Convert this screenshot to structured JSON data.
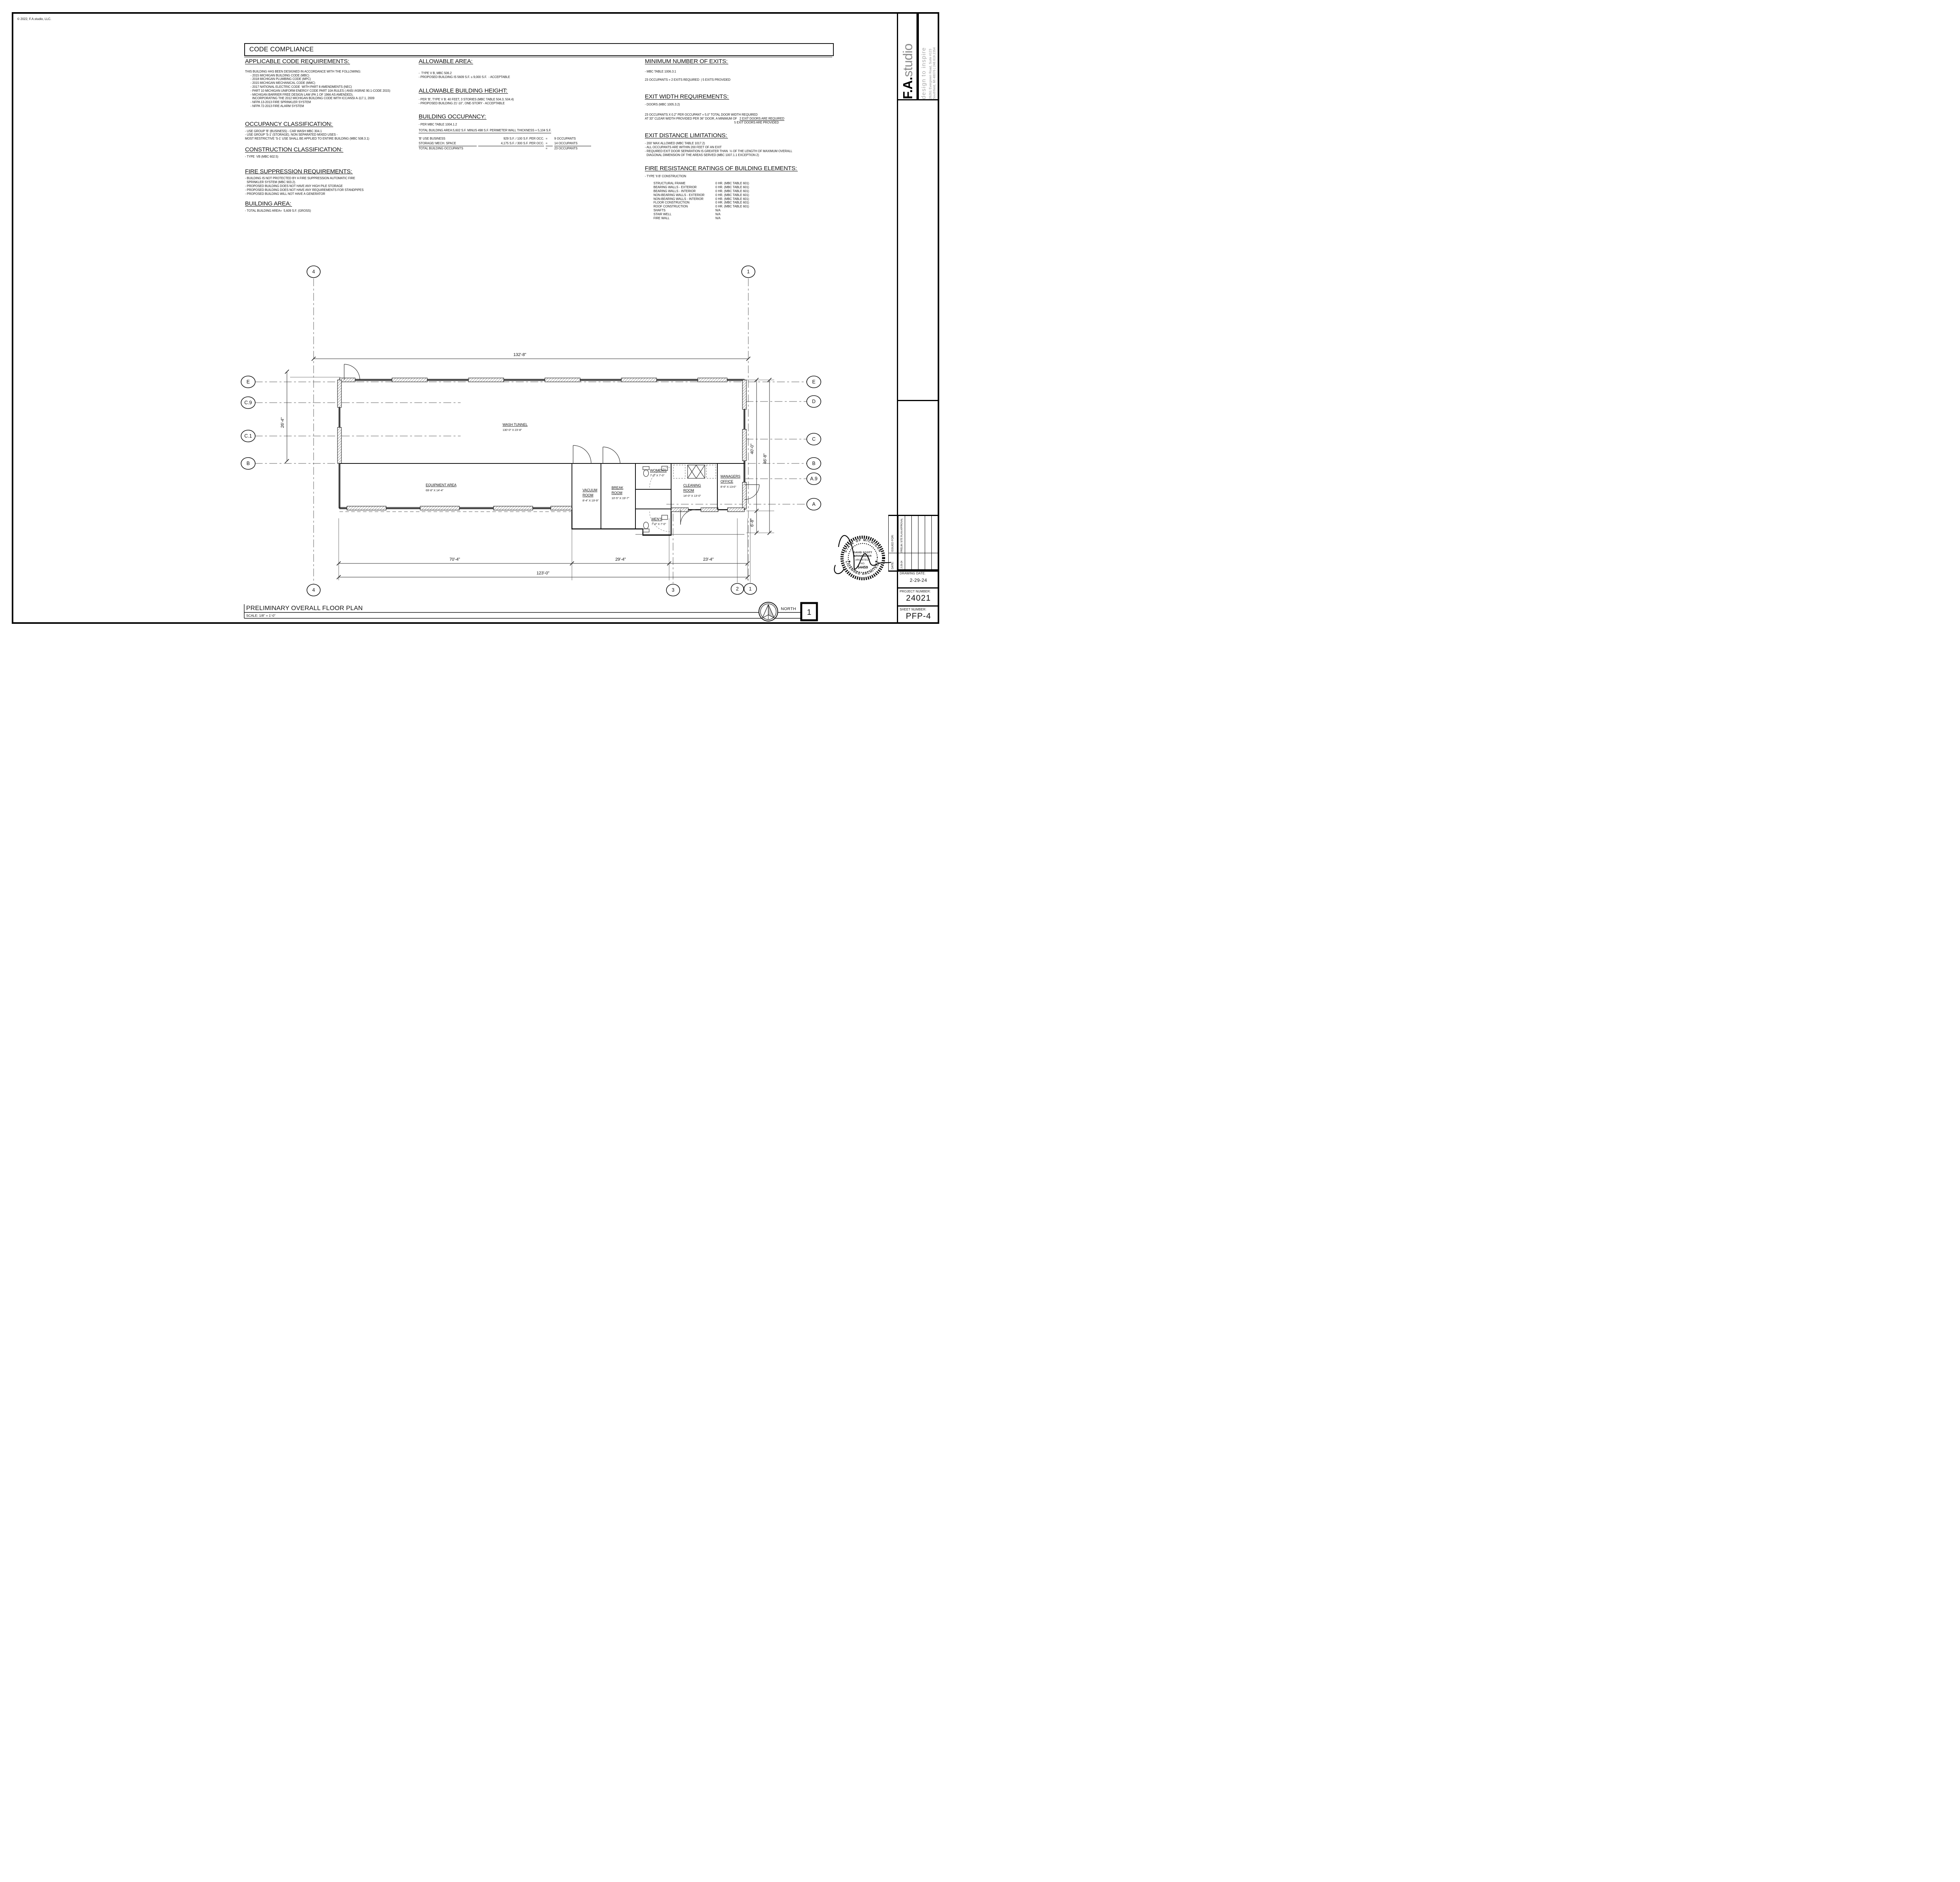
{
  "sheet": {
    "copyright": "© 2022, F.A.studio, LLC.",
    "footer": {
      "title": "PRELIMINARY  OVERALL FLOOR PLAN",
      "scale": "SCALE: 1/8\" = 1'-0\"",
      "north_label": "NORTH",
      "detail_number": "1"
    }
  },
  "code": {
    "title": "CODE COMPLIANCE",
    "applicable": {
      "heading": "APPLICABLE CODE REQUIREMENTS:",
      "intro": "THIS BUILDING HAS BEEN DESIGNED IN ACCORDANCE WITH THE FOLLOWING:",
      "items": [
        "- 2015 MICHIGAN BUILDING CODE (MBC)",
        "- 2018 MICHIGAN PLUMBING CODE (MPC)",
        "- 2015 MICHIGAN MECHANICAL CODE (MMC)",
        "- 2017 NATIONAL ELECTRIC CODE  WITH PART 8 AMENDMENTS (NEC)",
        "- PART 10 MICHIGAN UNIFORM ENERGY CODE PART 10A RULES ( ANSI /ASRAE 90.1-CODE 2015)",
        "- MICHIGAN BARRIER FREE DESIGN LAW (PA 1 OF 1966 AS AMENDED),",
        "  INCORPORATING THE 2012 MICHIGAN BUILDING CODE WITH ICC/ANSI A-117.1, 2009",
        "- NFPA 13-2013 FIRE SPRINKLER SYSTEM",
        "- NFPA 72-2013 FIRE ALARM SYSTEM"
      ]
    },
    "occupancy_class": {
      "heading": "OCCUPANCY CLASSIFICATION:",
      "items": [
        "- USE GROUP 'B' (BUSINESS) - CAR WASH MBC 304.1",
        "- USE GROUP 'S-1' (STORAGE). NON SEPARATED MIXED USES -",
        "MOST RESTRICTIVE 'S-1' USE SHALL BE APPLIED TO ENTIRE BUILDING (MBC 508.3.1)"
      ]
    },
    "construction_class": {
      "heading": "CONSTRUCTION CLASSIFICATION:",
      "items": [
        "- TYPE  VB (MBC 602.5)"
      ]
    },
    "fire_suppression": {
      "heading": "FIRE SUPPRESSION REQUIREMENTS:",
      "items": [
        "- BUILDING IS NOT PROTECTED BY A FIRE SUPPRESSION AUTOMATIC FIRE",
        "  SPRINKLER SYSTEM (MBC 903.2).",
        "- PROPOSED BUILDING DOES NOT HAVE ANY HIGH PILE STORAGE",
        "- PROPOSED BUILDING DOES NOT HAVE ANY REQUIREMENTS FOR STANDPIPES",
        "- PROPOSED BUILDING WILL NOT HAVE A GENERATOR"
      ]
    },
    "building_area": {
      "heading": "BUILDING AREA:",
      "items": [
        "- TOTAL BUILDING AREA=  5,609 S.F. (GROSS)"
      ]
    },
    "allowable_area": {
      "heading": "ALLOWABLE AREA:",
      "items": [
        "-  TYPE V B, MBC 506.2",
        "- PROPOSED BUILDING IS 5609 S.F. ≤ 9,000 S.F.  - ACCEPTABLE"
      ]
    },
    "allowable_height": {
      "heading": "ALLOWABLE BUILDING HEIGHT:",
      "items": [
        "- PER 'B', TYPE V B: 40 FEET, 3 STORIES (MBC TABLE 504.3, 504.4)",
        "- PROPOSED BUILDING 21'-10\", ONE-STORY - ACCEPTABLE"
      ]
    },
    "building_occupancy": {
      "heading": "BUILDING OCCUPANCY:",
      "note": "- PER MBC TABLE 1004.1.2",
      "area_line": "TOTAL BUILDING AREA:5,602 S.F. MINUS 498 S.F. PERIMETER WALL THICKNESS = 5,104 S.F.",
      "rows": [
        {
          "use": "'B' USE BUSINESS",
          "calc": "929 S.F. / 100 S.F. PER OCC.",
          "eq": "=",
          "occ": "9 OCCUPANTS"
        },
        {
          "use": "STORAGE/ MECH. SPACE",
          "calc": "4,175 S.F. / 300 S.F. PER OCC.",
          "eq": "=",
          "occ": "14 OCCUPANTS"
        },
        {
          "use": "TOTAL BUILDING OCCUPANTS",
          "calc": "",
          "eq": "=",
          "occ": "23 OCCUPANTS"
        }
      ]
    },
    "min_exits": {
      "heading": "MINIMUM NUMBER OF EXITS:",
      "items": [
        "- MBC TABLE 1006.3.1",
        "23 OCCUPANTS = 2 EXITS REQUIRED  | 5 EXITS PROVIDED"
      ]
    },
    "exit_width": {
      "heading": "EXIT WIDTH REQUIREMENTS:",
      "items": [
        "- DOORS (MBC 1005.3.2)",
        "23 OCCUPANTS X 0.2\" PER OCCUPANT = 5.0\" TOTAL DOOR WIDTH REQUIRED"
      ],
      "min_line_prefix": "AT 33\" CLEAR WIDTH PROVIDED PER 36\" DOOR, A MINIMUM OF   ",
      "required_line": "2 EXIT DOORS ARE REQUIRED",
      "provided_line": "5 EXIT DOORS ARE PROVIDED"
    },
    "exit_distance": {
      "heading": "EXIT DISTANCE LIMITATIONS:",
      "items": [
        "- 200' MAX ALLOWED (MBC TABLE 1017.2)",
        "- ALL OCCUPANTS ARE WITHIN 200 FEET OF AN EXIT",
        "- REQUIRED EXIT DOOR SEPARATION IS GREATER THAN  ⅓ OF THE LENGTH OF MAXIMUM OVERALL",
        "  DIAGONAL DIMENSION OF THE AREAS SERVED (MBC 1007.1.1 EXCEPTION 2)"
      ]
    },
    "fire_resistance": {
      "heading": "FIRE RESISTANCE RATINGS OF BUILDING ELEMENTS:",
      "note": "- TYPE 'II B' CONSTRUCTION",
      "rows": [
        {
          "label": "STRUCTURAL FRAME",
          "value": "0 HR. (MBC TABLE 601)"
        },
        {
          "label": "BEARING WALLS - EXTERIOR",
          "value": "0 HR. (MBC TABLE 601)"
        },
        {
          "label": "BEARING WALLS - INTERIOR",
          "value": "0 HR. (MBC TABLE 601)"
        },
        {
          "label": "NON-BEARING WALLS - EXTERIOR",
          "value": "0 HR. (MBC TABLE 601)"
        },
        {
          "label": "NON-BEARING WALLS - INTERIOR",
          "value": "0 HR. (MBC TABLE 601)"
        },
        {
          "label": "FLOOR CONSTRUCTION",
          "value": "0 HR. (MBC TABLE 601)"
        },
        {
          "label": "ROOF CONSTRUCTION",
          "value": "0 HR. (MBC TABLE 601)"
        },
        {
          "label": "SHAFTS",
          "value": "N/A"
        },
        {
          "label": "STAIR WELL",
          "value": "N/A"
        },
        {
          "label": "FIRE WALL",
          "value": "N/A"
        }
      ]
    }
  },
  "plan": {
    "rooms": [
      {
        "line1": "WASH TUNNEL",
        "dims": "130'-0\" X 23'-8\""
      },
      {
        "line1": "EQUIPMENT AREA",
        "dims": "69'-8\" X 14'-4\""
      },
      {
        "line1": "VACUUM",
        "line2": "ROOM",
        "dims": "8'-4\" X 19'-9\""
      },
      {
        "line1": "BREAK",
        "line2": "ROOM",
        "dims": "10'-5\" X 19'-7\""
      },
      {
        "line1": "WOMEN'S",
        "dims": "7'-0\" X 7'-0\""
      },
      {
        "line1": "MEN'S",
        "dims": "7'-0\" X 7'-0\""
      },
      {
        "line1": "CLEANING",
        "line2": "ROOM",
        "dims": "14'-0\" X 13'-0\""
      },
      {
        "line1": "MANAGERS",
        "line2": "OFFICE",
        "dims": "8'-6\" X 13-0\""
      }
    ],
    "dimensions": {
      "top": "132'-8\"",
      "seg1": "70'-4\"",
      "seg2": "29'-4\"",
      "seg3": "23'-4\"",
      "overall": "123'-0\"",
      "left": "26'-4\"",
      "right_a": "40'-0\"",
      "right_b": "46'-8\"",
      "canopy": "6'-8\""
    },
    "bubbles": {
      "top": [
        "4",
        "1"
      ],
      "bottom": [
        "4",
        "3",
        "2",
        "1"
      ],
      "left": [
        "E",
        "C.9",
        "C.1",
        "B"
      ],
      "right": [
        "E",
        "D",
        "C",
        "B",
        "A.9",
        "A"
      ]
    }
  },
  "titleblock": {
    "brand": {
      "prefix": "F.A.",
      "suffix": "studio",
      "tagline": "design to inspire",
      "address1": "26261 Evergreen Road, Suite #123",
      "address2": "Southfield, MI 48076 | 248.619.2354"
    },
    "project": {
      "label": "PROJECT NAME:",
      "name": "JAX KAR WASH",
      "location": "TROY, MI"
    },
    "revisions": {
      "issued_label": "ISSUED FOR:",
      "date_label": "DATE:",
      "entry_issued": "PRELIM. SITE PLAN APPROVAL",
      "entry_date": "2-29-24"
    },
    "drawing_date": {
      "label": "DRAWING DATE:",
      "value": "2-29-24"
    },
    "project_number": {
      "label": "PROJECT NUMBER:",
      "value": "24021"
    },
    "sheet_number": {
      "label": "SHEET NUMBER:",
      "value": "PFP-4"
    },
    "seal": {
      "top": "STATE OF MICHIGAN",
      "bottom": "LICENSED ARCHITECT",
      "l1": "DAVID SCOTT",
      "l2": "BRINKMEIER",
      "l3": "ARCHITECT",
      "l4": "NO.",
      "l5": "54459",
      "star": "★"
    }
  }
}
